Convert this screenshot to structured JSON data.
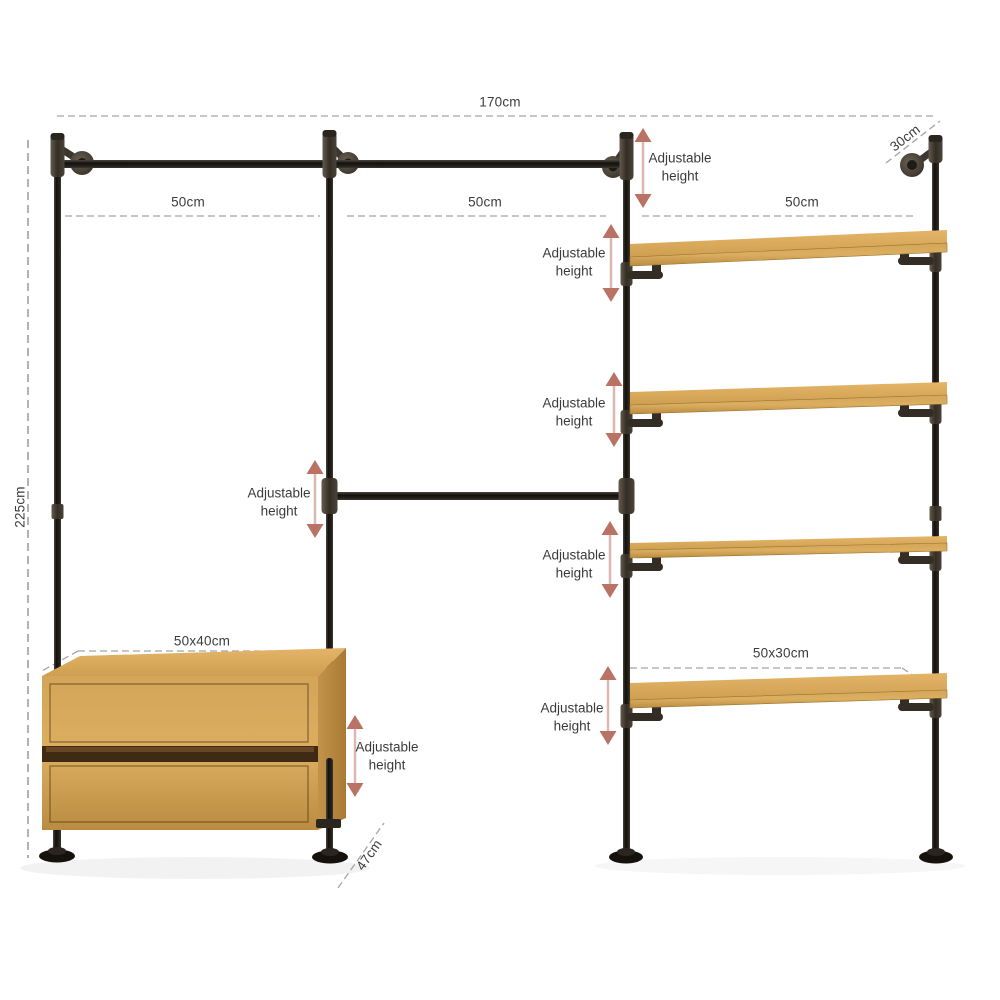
{
  "diagram_title": "wardrobe-pipe-shelving-dimension-diagram",
  "labels": {
    "total_width": "170cm",
    "total_height": "225cm",
    "section_1_width": "50cm",
    "section_2_width": "50cm",
    "section_3_width": "50cm",
    "shelf_depth": "30cm",
    "dresser_size": "50x40cm",
    "bottom_shelf_size": "50x30cm",
    "base_depth": "47cm"
  },
  "adjustable_height_labels": [
    "Adjustable\nheight",
    "Adjustable\nheight",
    "Adjustable\nheight",
    "Adjustable\nheight",
    "Adjustable\nheight",
    "Adjustable\nheight",
    "Adjustable\nheight"
  ],
  "colors": {
    "background": "#ffffff",
    "dimension_text": "#3c3c3c",
    "dashed_line": "#a5a5a5",
    "arrow": "#b97264",
    "pipe": "#1a1713",
    "pipe_fitting": "#4e463c",
    "wood": "#d7a758"
  }
}
